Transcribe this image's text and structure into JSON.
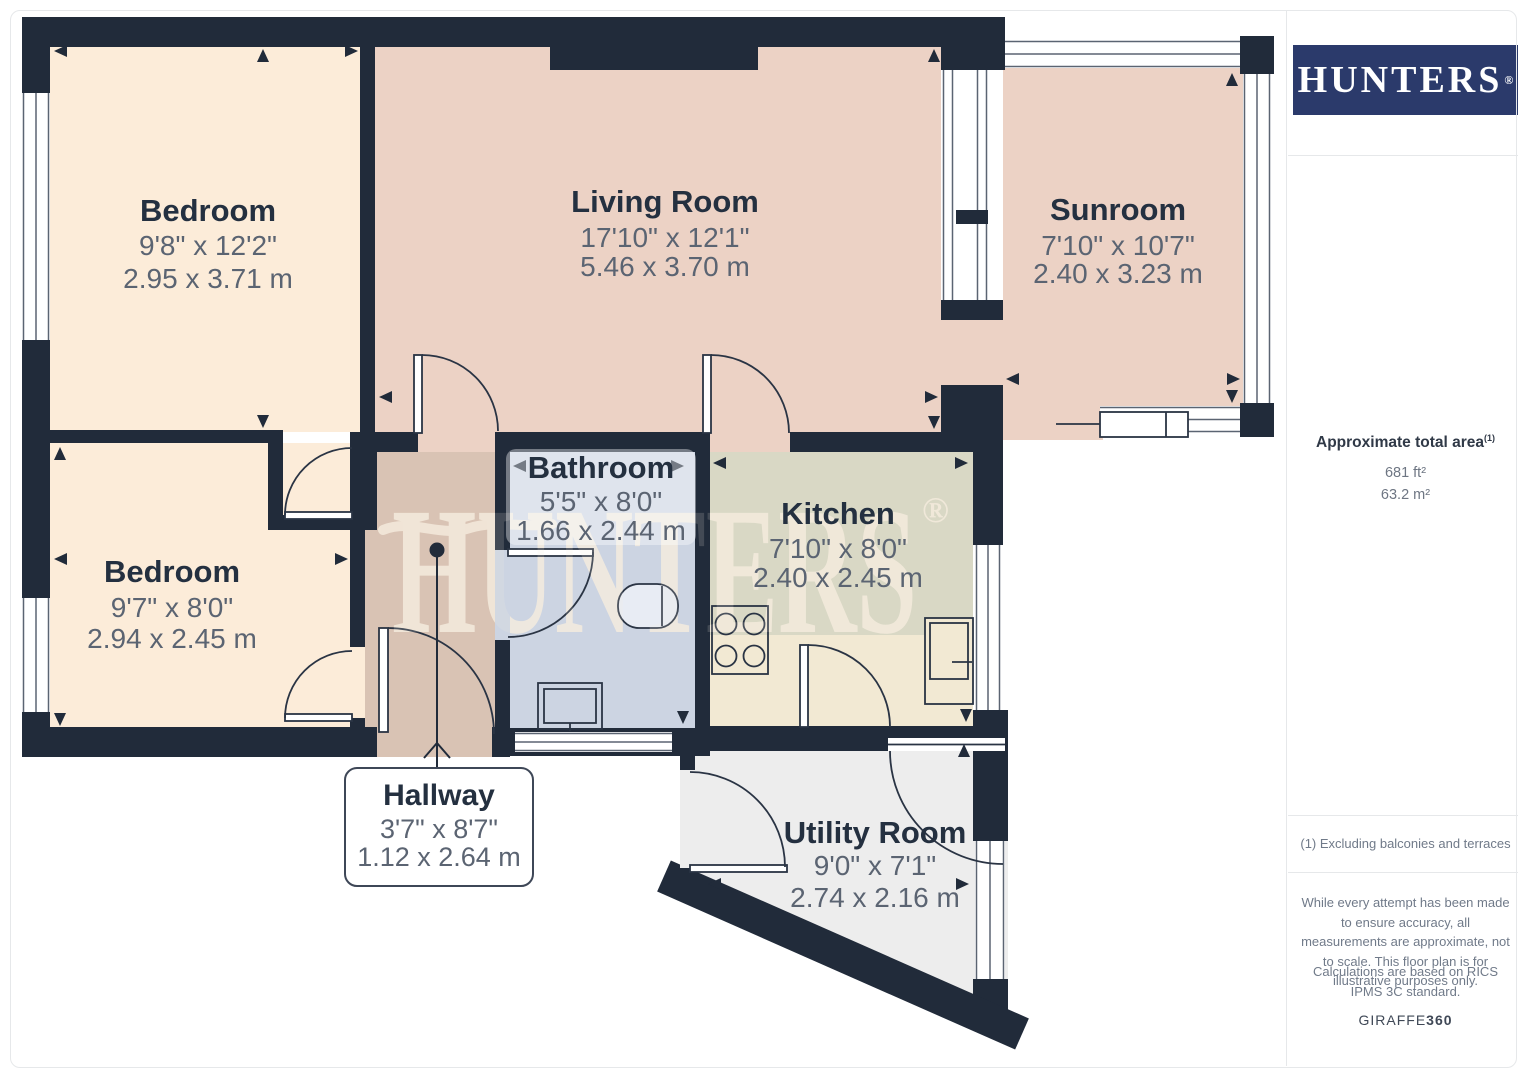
{
  "brand": {
    "logo": "HUNTERS",
    "registered": "®"
  },
  "watermark": {
    "text": "HUNTERS",
    "registered": "®"
  },
  "rooms": {
    "bedroom1": {
      "name": "Bedroom",
      "imperial": "9'8\" x 12'2\"",
      "metric": "2.95 x 3.71 m"
    },
    "living": {
      "name": "Living Room",
      "imperial": "17'10\" x 12'1\"",
      "metric": "5.46 x 3.70 m"
    },
    "sunroom": {
      "name": "Sunroom",
      "imperial": "7'10\" x 10'7\"",
      "metric": "2.40 x 3.23 m"
    },
    "bedroom2": {
      "name": "Bedroom",
      "imperial": "9'7\" x 8'0\"",
      "metric": "2.94 x 2.45 m"
    },
    "bathroom": {
      "name": "Bathroom",
      "imperial": "5'5\" x 8'0\"",
      "metric": "1.66 x 2.44 m"
    },
    "kitchen": {
      "name": "Kitchen",
      "imperial": "7'10\" x 8'0\"",
      "metric": "2.40 x 2.45 m"
    },
    "hallway": {
      "name": "Hallway",
      "imperial": "3'7\" x 8'7\"",
      "metric": "1.12 x 2.64 m"
    },
    "utility": {
      "name": "Utility Room",
      "imperial": "9'0\" x 7'1\"",
      "metric": "2.74 x 2.16 m"
    }
  },
  "sidebar": {
    "area_title": "Approximate total area",
    "area_footnote_marker": "(1)",
    "area_imperial": "681 ft²",
    "area_metric": "63.2 m²",
    "footnote": "(1) Excluding balconies and terraces",
    "disclaimer": "While every attempt has been made to ensure accuracy, all measurements are approximate, not to scale. This floor plan is for illustrative purposes only.",
    "standard": "Calculations are based on RICS IPMS 3C standard.",
    "credit_name": "GIRAFFE",
    "credit_suffix": "360"
  },
  "colors": {
    "wall": "#212b3a",
    "bedroom_fill": "#fcecd9",
    "living_fill": "#ecd2c5",
    "hallway_fill": "#d9c3b4",
    "bathroom_fill": "#ccd4e2",
    "kitchen_fill": "#d9d8c5",
    "counter_fill": "#f2e9d3",
    "utility_fill": "#ededed",
    "window_frame": "#5b6472",
    "logo_bg": "#2b3a6b",
    "label_text": "#243040",
    "dim_text": "#5b6472"
  }
}
